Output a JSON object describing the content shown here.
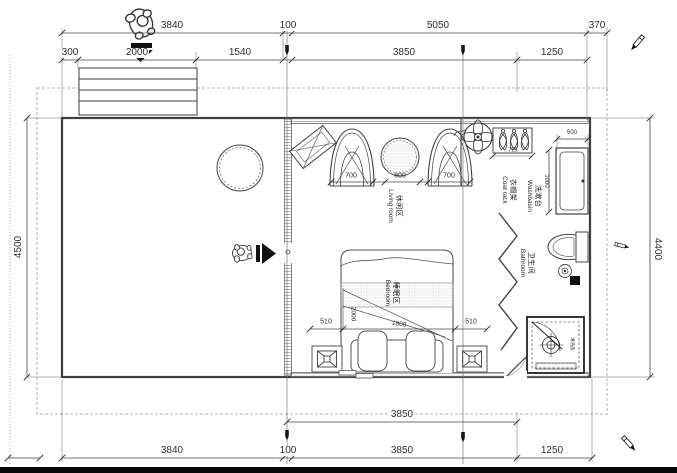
{
  "plan": {
    "dims": {
      "top1": [
        "3840",
        "100",
        "5050",
        "370"
      ],
      "top2": [
        "300",
        "2000",
        "1540",
        "3850",
        "1250"
      ],
      "left": "4500",
      "right": "4400",
      "bottom1": [
        "3850"
      ],
      "bottom2": [
        "3840",
        "100",
        "3850",
        "1250"
      ]
    },
    "living": {
      "zh": "休闲区",
      "en": "Living room",
      "d1": "700",
      "d2": "600",
      "d3": "700"
    },
    "bedroom": {
      "zh": "睡眠区",
      "en": "Bedroom",
      "d1": "510",
      "d2": "1800",
      "d3": "510",
      "d4": "2000"
    },
    "coat": {
      "zh": "衣帽架",
      "en": "Coat rack",
      "d": "725"
    },
    "wash": {
      "zh": "洗漱台",
      "en": "Washbasin",
      "d1": "500",
      "d2": "1000"
    },
    "bath": {
      "zh": "卫生间",
      "en": "Bathroom"
    },
    "shower": {
      "label": "淋浴房"
    },
    "colors": {
      "line": "#3d3d3d",
      "accent": "#111111"
    }
  }
}
